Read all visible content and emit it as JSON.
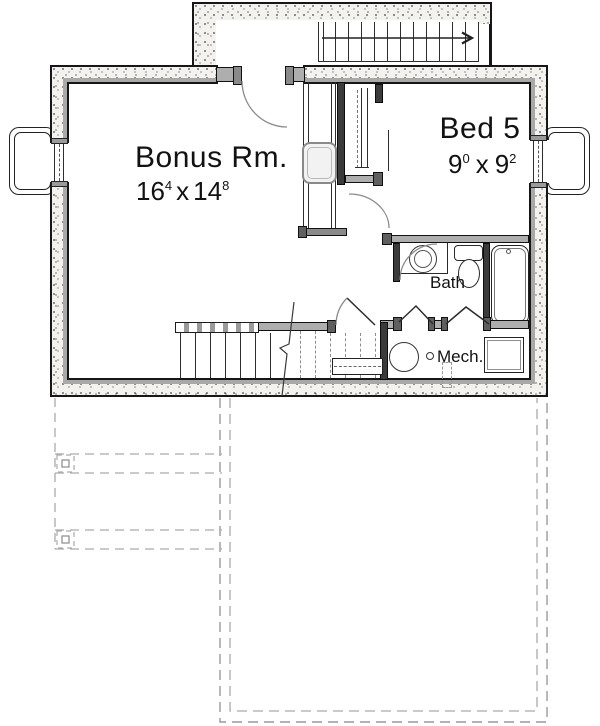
{
  "plan": {
    "type": "basement-floor-plan",
    "rooms": {
      "bonus": {
        "name": "Bonus Rm.",
        "w_ft": "16",
        "w_in": "4",
        "sep": "x",
        "h_ft": "14",
        "h_in": "8"
      },
      "bed5": {
        "name": "Bed 5",
        "w_ft": "9",
        "w_in": "0",
        "sep": "x",
        "h_ft": "9",
        "h_in": "2"
      },
      "bath": {
        "name": "Bath"
      },
      "mech": {
        "name": "Mech."
      }
    },
    "fixtures": [
      "vanity-sink",
      "toilet",
      "bathtub",
      "water-heater",
      "furnace",
      "floor-drain",
      "chimney-flue",
      "closet-rod",
      "under-stair-shelf"
    ],
    "stairs": {
      "upper_run_direction": "right",
      "arrow_icon": "stair-direction-arrow",
      "lower_run": "basement-stairs-with-break-line"
    },
    "outdoor": {
      "deck_outline": "dashed",
      "porch_bands": 2,
      "post_footings": 2
    },
    "colors": {
      "wall_fill_gray": "#aeaeae",
      "partition_dark": "#3b3b3b",
      "concrete_stipple_bg": "#f3f2ef",
      "inner_band_gray": "#a9a9a9",
      "dashed_outline_gray": "#a8a8a8",
      "line_black": "#161616"
    }
  }
}
